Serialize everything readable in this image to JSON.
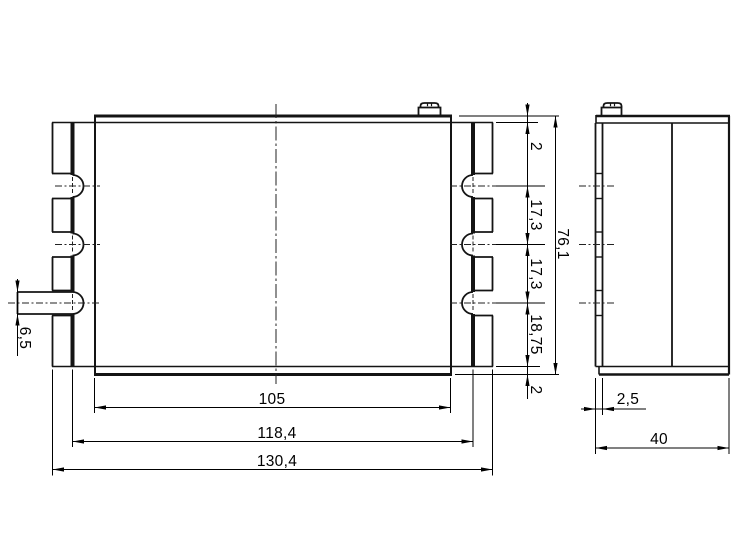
{
  "drawing": {
    "title": "enclosure-two-view-drawing",
    "views": {
      "front_label": "front-view",
      "side_label": "side-view"
    }
  },
  "dims": {
    "front": {
      "top_gap": "2",
      "hole_pitch_1": "17,3",
      "hole_pitch_2": "17,3",
      "hole_to_bottom": "18,75",
      "bottom_gap": "2",
      "total_height": "76,1",
      "body_width": "105",
      "mount_width": "118,4",
      "total_width": "130,4",
      "pin_diameter": "6,5"
    },
    "side": {
      "flange_thickness": "2,5",
      "depth": "40"
    }
  }
}
